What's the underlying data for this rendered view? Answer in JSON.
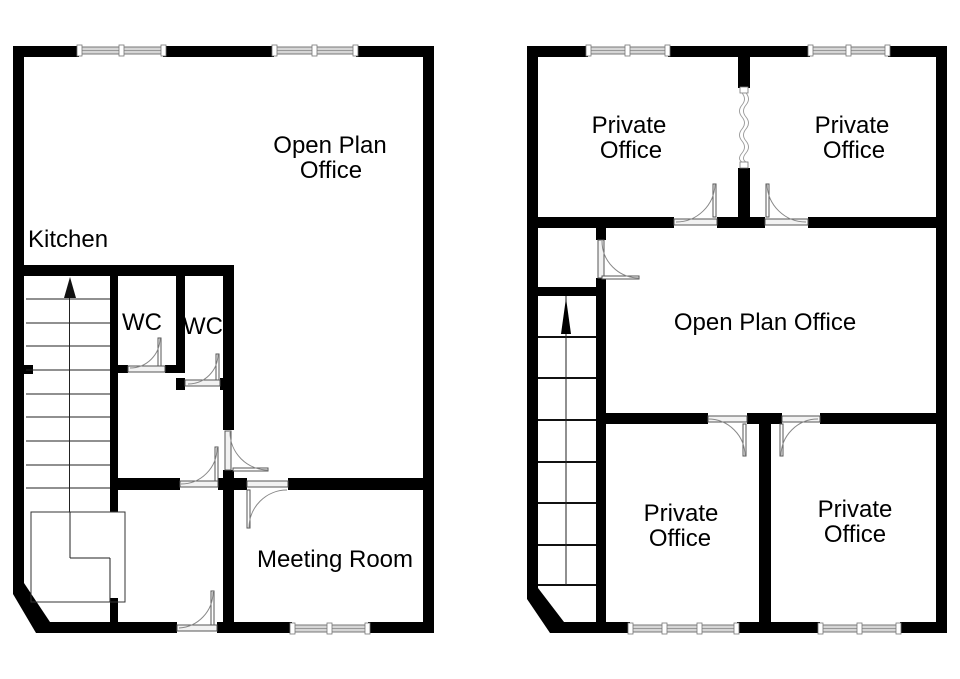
{
  "colors": {
    "wall": "#000000",
    "line": "#888888"
  },
  "ground_floor": {
    "rooms": [
      {
        "id": "open-plan-office",
        "lines": [
          "Open Plan",
          "Office"
        ]
      },
      {
        "id": "kitchen",
        "lines": [
          "Kitchen"
        ]
      },
      {
        "id": "wc-left",
        "lines": [
          "WC"
        ]
      },
      {
        "id": "wc-right",
        "lines": [
          "WC"
        ]
      },
      {
        "id": "meeting-room",
        "lines": [
          "Meeting Room"
        ]
      }
    ]
  },
  "first_floor": {
    "rooms": [
      {
        "id": "private-office-top-left",
        "lines": [
          "Private",
          "Office"
        ]
      },
      {
        "id": "private-office-top-right",
        "lines": [
          "Private",
          "Office"
        ]
      },
      {
        "id": "open-plan-office",
        "lines": [
          "Open Plan Office"
        ]
      },
      {
        "id": "private-office-bottom-left",
        "lines": [
          "Private",
          "Office"
        ]
      },
      {
        "id": "private-office-bottom-right",
        "lines": [
          "Private",
          "Office"
        ]
      }
    ]
  }
}
